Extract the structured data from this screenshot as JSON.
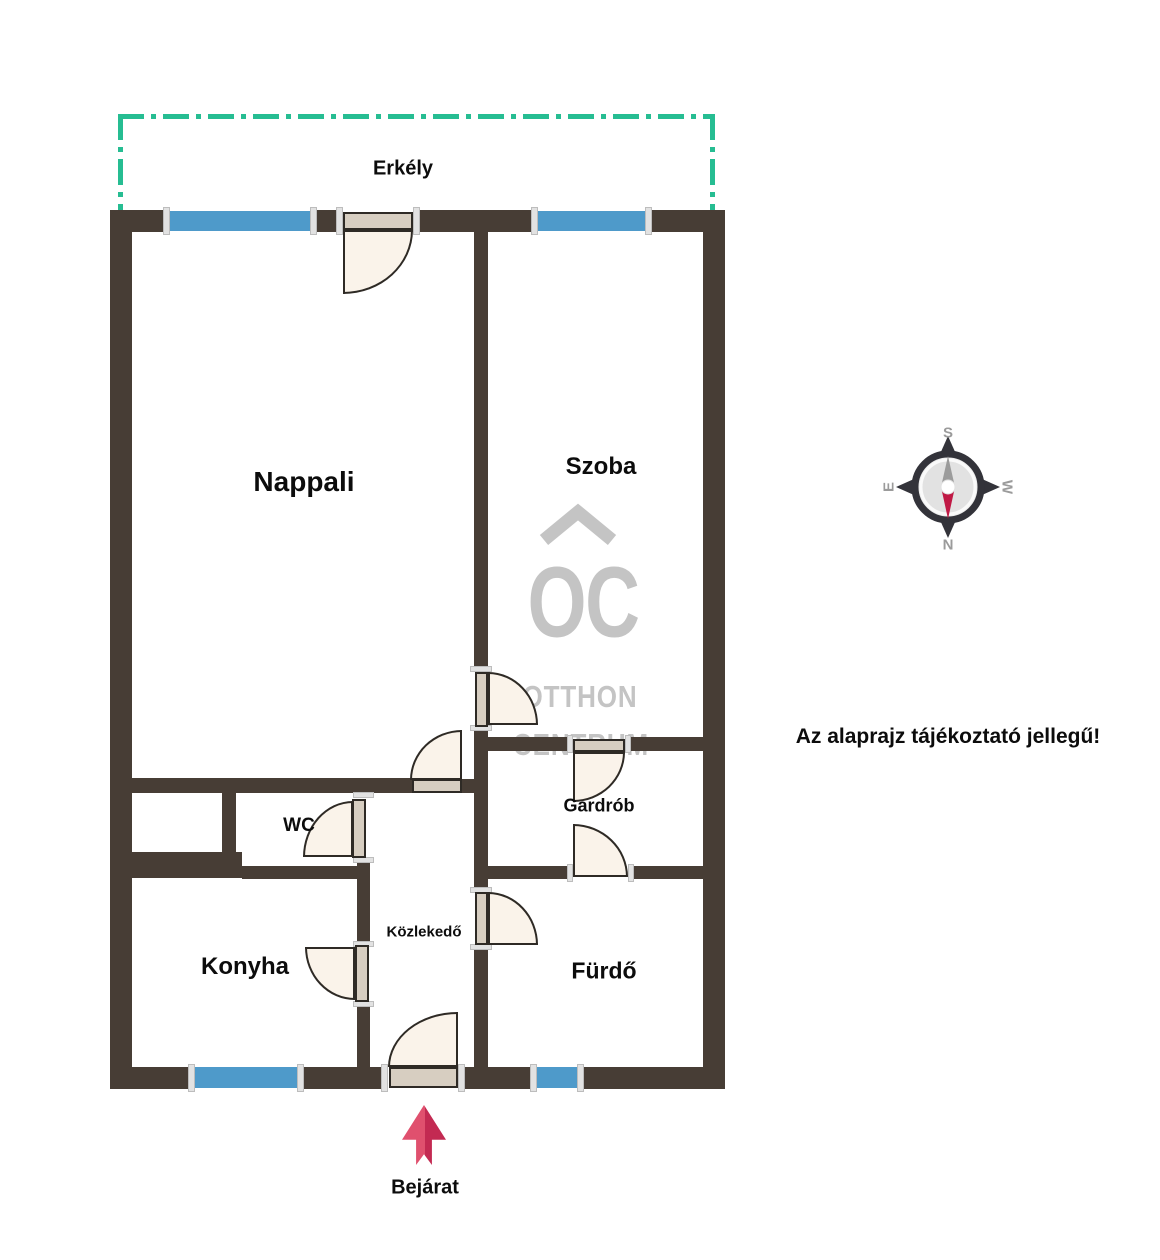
{
  "rooms": {
    "erkely": "Erkély",
    "nappali": "Nappali",
    "szoba": "Szoba",
    "wc": "WC",
    "gardrob": "Gardrób",
    "konyha": "Konyha",
    "kozlekedo": "Közlekedő",
    "furdo": "Fürdő"
  },
  "entrance_label": "Bejárat",
  "disclaimer": "Az alaprajz tájékoztató jellegű!",
  "watermark": {
    "monogram": "OC",
    "line1": "OTTHON",
    "line2": "CENTRUM"
  },
  "compass": {
    "n": "N",
    "s": "S",
    "e": "E",
    "w": "W"
  },
  "colors": {
    "wall": "#473d35",
    "win": "#4e9aca",
    "teal": "#26bd92",
    "doorfill": "#faf3ea",
    "doorpanel": "#d7cec1",
    "dooredge": "#2e2a25",
    "wm": "#c4c4c4",
    "compassdark": "#33333a",
    "compassface": "#e2e2e2",
    "needlegray": "#9b9b9b",
    "needlered": "#c01945"
  }
}
